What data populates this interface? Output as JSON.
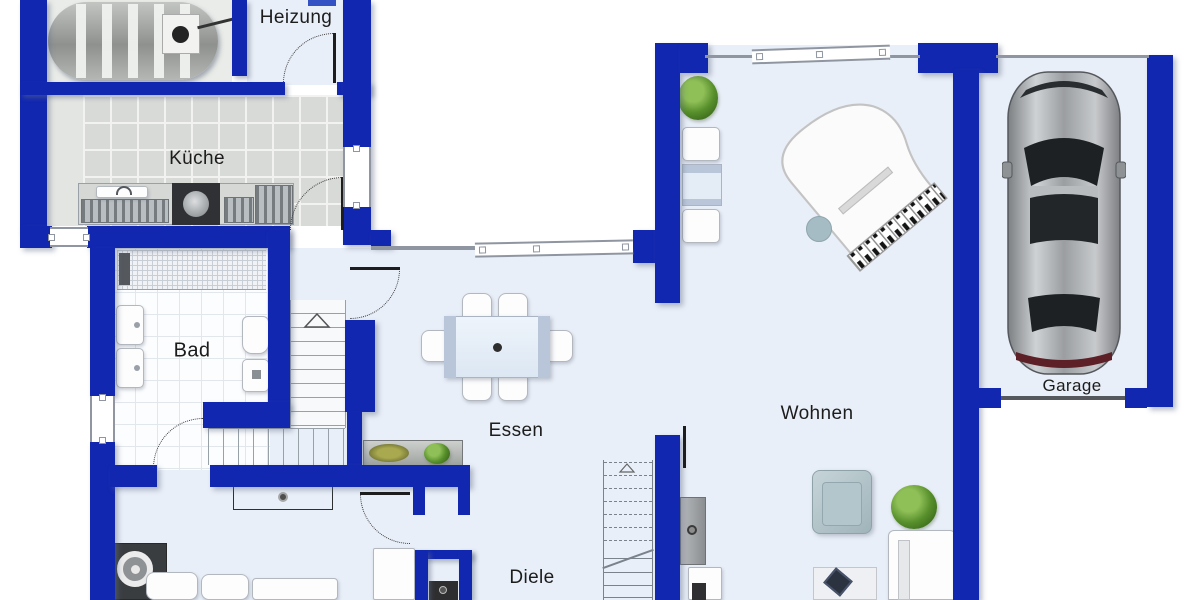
{
  "plan": {
    "title": "Grundriss Erdgeschoss",
    "rooms": [
      {
        "id": "heizung",
        "label": "Heizung"
      },
      {
        "id": "kueche",
        "label": "Küche"
      },
      {
        "id": "bad",
        "label": "Bad"
      },
      {
        "id": "essen",
        "label": "Essen"
      },
      {
        "id": "wohnen",
        "label": "Wohnen"
      },
      {
        "id": "diele",
        "label": "Diele"
      },
      {
        "id": "garage",
        "label": "Garage"
      }
    ],
    "colors": {
      "wall": "#1127b0",
      "floor": "#e9eff8",
      "outside": "#ffffff",
      "kitchen_tile": "#d8dad7",
      "bath_tile": "#fcfdfe",
      "line": "#8f96a1",
      "label_text": "#1c1c1c",
      "plant_green": "#4f7d2a",
      "car_body": "#9fa3a7",
      "dark_furniture": "#3c3e40"
    }
  }
}
